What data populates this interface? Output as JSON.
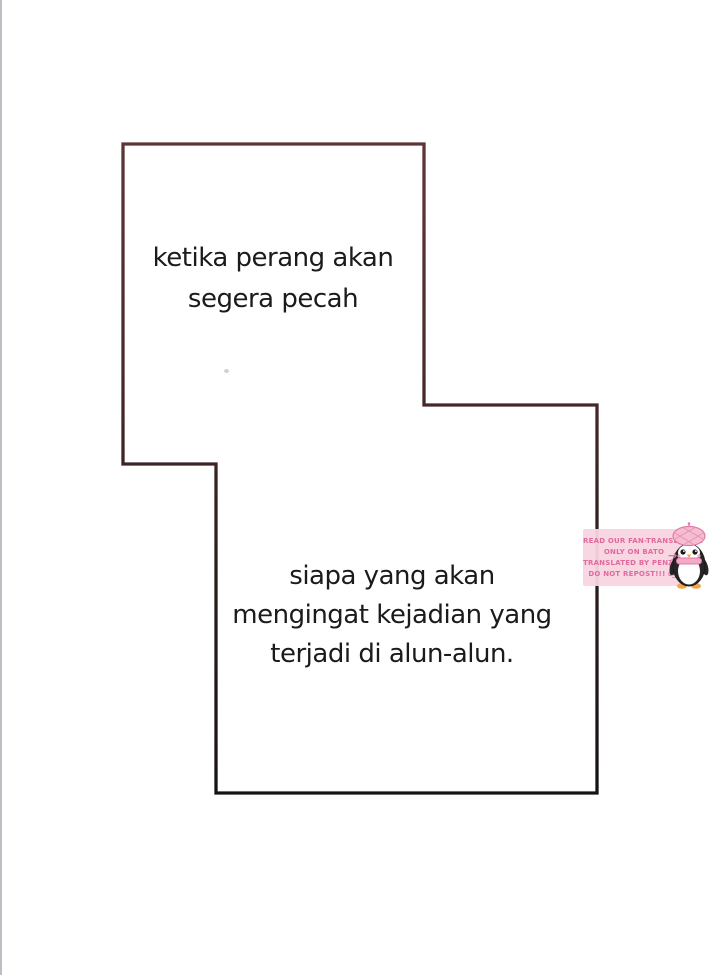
{
  "page": {
    "background_color": "#ffffff",
    "edge_line_color": "#a8a8b0"
  },
  "panel": {
    "border_top_color": "#5d3635",
    "border_bottom_color": "#171313"
  },
  "dialogue": {
    "text_color": "#1b1b1b",
    "caption1": {
      "lines": [
        "ketika perang akan",
        "segera pecah"
      ]
    },
    "caption2": {
      "lines": [
        "siapa yang akan",
        "mengingat kejadian yang",
        "terjadi di alun-alun."
      ]
    }
  },
  "watermark": {
    "box_color": "#f8d5e1",
    "text_color": "#e06a9c",
    "lines": [
      "READ OUR FAN-TRANSLATION",
      "ONLY ON BATO",
      "TRANSLATED BY PENZACAFE",
      "DO NOT REPOST!!! ಠ_ಠ"
    ],
    "arrow": "→",
    "mascot": "penguin"
  }
}
